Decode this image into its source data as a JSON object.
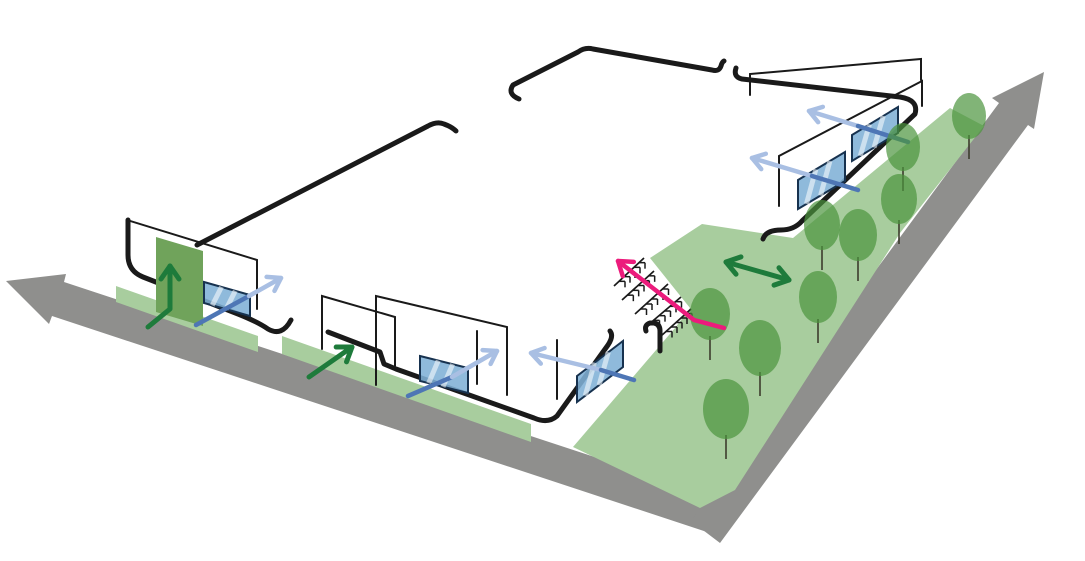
{
  "diagram": {
    "kind": "architectural-site-axonometric-diagram",
    "canvas": {
      "width": 1085,
      "height": 561,
      "background": "#ffffff"
    },
    "colors": {
      "road": "#8F8F8D",
      "lawn": "#A8CD9E",
      "tree": "#4B943D",
      "tree_stem": "#3C3C2C",
      "panel_green": "#70A35B",
      "glass_fill": "#7FB0D6",
      "glass_border": "#17324F",
      "glass_streak": "#FFFFFF",
      "outline": "#1A1A1A",
      "green_dark": "#1E7B3B",
      "blue_light": "#A9BFE3",
      "blue_dark": "#4E76B5",
      "pink": "#EC1B7C"
    },
    "roads": [
      {
        "name": "road-arrow-left",
        "points": [
          [
            6,
            281
          ],
          [
            66,
            274
          ],
          [
            64,
            282
          ],
          [
            728,
            501
          ],
          [
            716,
            535
          ],
          [
            52,
            316
          ],
          [
            49,
            324
          ]
        ]
      },
      {
        "name": "road-arrow-right",
        "points": [
          [
            1044,
            72
          ],
          [
            1034,
            129
          ],
          [
            1028,
            125
          ],
          [
            720,
            543
          ],
          [
            691,
            521
          ],
          [
            999,
            103
          ],
          [
            992,
            98
          ]
        ]
      }
    ],
    "lawns": [
      {
        "name": "lawn-strip-left",
        "points": [
          [
            116,
            286
          ],
          [
            258,
            336
          ],
          [
            258,
            352
          ],
          [
            116,
            302
          ]
        ]
      },
      {
        "name": "lawn-strip-center",
        "points": [
          [
            282,
            336
          ],
          [
            531,
            424
          ],
          [
            531,
            442
          ],
          [
            282,
            354
          ]
        ]
      },
      {
        "name": "lawn-main",
        "points": [
          [
            702,
            224
          ],
          [
            793,
            238
          ],
          [
            950,
            108
          ],
          [
            984,
            126
          ],
          [
            900,
            233
          ],
          [
            735,
            490
          ],
          [
            700,
            508
          ],
          [
            573,
            447
          ],
          [
            675,
            328
          ],
          [
            690,
            308
          ],
          [
            650,
            258
          ]
        ]
      }
    ],
    "outlines": [
      {
        "name": "building-outline-left",
        "d": "M 128,220 L 128,255 Q 128,271 143,277 L 238,314 Q 258,322 268,329 Q 282,337 291,320"
      },
      {
        "name": "site-outline-topleft",
        "d": "M 197,245 L 428,126 Q 437,121 444,124 Q 452,127 456,131"
      },
      {
        "name": "site-outline-top",
        "d": "M 519,99 Q 507,94 513,85 L 578,52 Q 585,47 593,49 L 712,70 Q 719,72 721,66 Q 722,62 724,61"
      },
      {
        "name": "building-outline-right",
        "d": "M 736,68 Q 733,77 742,79 L 900,97 Q 919,100 915,114 L 802,221 Q 794,230 781,230 Q 766,230 763,239"
      },
      {
        "name": "building-outline-center",
        "d": "M 328,332 L 380,352 L 384,364 L 396,369 L 534,418 Q 548,424 557,416 L 608,345 Q 614,336 610,331"
      },
      {
        "name": "building-outline-stair-edge",
        "d": "M 646,331 Q 644,325 650,323 L 654,323 Q 660,324 660,331 L 660,351"
      }
    ],
    "walls": [
      {
        "name": "wall-outline-left",
        "d": "M 127,244 L 127,220 L 257,260 L 257,309"
      },
      {
        "name": "wall-outline-center-a",
        "d": "M 322,349 L 322,296 L 395,317 L 395,366"
      },
      {
        "name": "wall-outline-center-b",
        "d": "M 376,385 L 376,296 L 507,327 L 507,395"
      },
      {
        "name": "wall-post-center",
        "d": "M 477,331 L 477,384"
      },
      {
        "name": "wall-post-corner",
        "d": "M 557,340 L 557,399"
      },
      {
        "name": "wall-outline-right",
        "d": "M 779,206 L 779,156 L 922,81 L 922,106"
      },
      {
        "name": "wall-outline-right-upper",
        "d": "M 750,95 L 750,74 L 921,59 L 921,80"
      }
    ],
    "green_panel": {
      "name": "green-wall-panel",
      "points": [
        [
          156,
          237
        ],
        [
          203,
          251
        ],
        [
          203,
          326
        ],
        [
          156,
          312
        ]
      ]
    },
    "glass_panels": [
      {
        "name": "glass-panel-left",
        "points": [
          [
            204,
            282
          ],
          [
            250,
            295
          ],
          [
            250,
            316
          ],
          [
            204,
            303
          ]
        ]
      },
      {
        "name": "glass-panel-center-1",
        "points": [
          [
            420,
            356
          ],
          [
            468,
            368
          ],
          [
            468,
            393
          ],
          [
            420,
            381
          ]
        ]
      },
      {
        "name": "glass-panel-center-2",
        "points": [
          [
            577,
            376
          ],
          [
            623,
            341
          ],
          [
            623,
            367
          ],
          [
            577,
            402
          ]
        ]
      },
      {
        "name": "glass-panel-right-1",
        "points": [
          [
            798,
            180
          ],
          [
            845,
            152
          ],
          [
            845,
            181
          ],
          [
            798,
            209
          ]
        ]
      },
      {
        "name": "glass-panel-right-2",
        "points": [
          [
            852,
            135
          ],
          [
            898,
            107
          ],
          [
            898,
            133
          ],
          [
            852,
            161
          ]
        ]
      }
    ],
    "stairs": {
      "name": "stairs-hatch",
      "rails": [
        [
          [
            614,
            286
          ],
          [
            644,
            258
          ]
        ],
        [
          [
            622,
            300
          ],
          [
            654,
            271
          ]
        ],
        [
          [
            635,
            314
          ],
          [
            668,
            284
          ]
        ],
        [
          [
            648,
            325
          ],
          [
            681,
            297
          ]
        ],
        [
          [
            661,
            336
          ],
          [
            691,
            309
          ]
        ]
      ],
      "steps_per_rail": 5,
      "step_size": 6
    },
    "arrows": [
      {
        "name": "airflow-arrow-left-dark",
        "pts": [
          [
            196,
            325
          ],
          [
            249,
            296
          ]
        ],
        "color": "blue_dark",
        "w": 4.5,
        "head": "none",
        "layer": 1
      },
      {
        "name": "airflow-arrow-left",
        "pts": [
          [
            249,
            296
          ],
          [
            281,
            278
          ]
        ],
        "color": "blue_light",
        "w": 4.5,
        "head": "end",
        "layer": 1
      },
      {
        "name": "airflow-arrow-center1-dark",
        "pts": [
          [
            408,
            396
          ],
          [
            452,
            377
          ]
        ],
        "color": "blue_dark",
        "w": 4.5,
        "head": "none",
        "layer": 1
      },
      {
        "name": "airflow-arrow-center1",
        "pts": [
          [
            452,
            377
          ],
          [
            497,
            351
          ]
        ],
        "color": "blue_light",
        "w": 4.5,
        "head": "end",
        "layer": 1
      },
      {
        "name": "airflow-arrow-center2",
        "pts": [
          [
            531,
            353
          ],
          [
            601,
            370
          ]
        ],
        "color": "blue_light",
        "w": 4.5,
        "head": "start",
        "layer": 1
      },
      {
        "name": "airflow-arrow-center2-dark",
        "pts": [
          [
            601,
            370
          ],
          [
            634,
            380
          ]
        ],
        "color": "blue_dark",
        "w": 4.5,
        "head": "none",
        "layer": 1
      },
      {
        "name": "airflow-arrow-right1",
        "pts": [
          [
            752,
            158
          ],
          [
            812,
            176
          ]
        ],
        "color": "blue_light",
        "w": 4.5,
        "head": "start",
        "layer": 1
      },
      {
        "name": "airflow-arrow-right1-dark",
        "pts": [
          [
            812,
            176
          ],
          [
            858,
            190
          ]
        ],
        "color": "blue_dark",
        "w": 4.5,
        "head": "none",
        "layer": 1
      },
      {
        "name": "airflow-arrow-right2",
        "pts": [
          [
            809,
            111
          ],
          [
            858,
            126
          ]
        ],
        "color": "blue_light",
        "w": 4.5,
        "head": "start",
        "layer": 1
      },
      {
        "name": "airflow-arrow-right2-dark",
        "pts": [
          [
            858,
            126
          ],
          [
            908,
            142
          ]
        ],
        "color": "blue_dark",
        "w": 4.5,
        "head": "none",
        "layer": 1
      },
      {
        "name": "green-arrow-up-panel",
        "pts": [
          [
            148,
            327
          ],
          [
            170,
            309
          ],
          [
            170,
            266
          ]
        ],
        "color": "green_dark",
        "w": 5,
        "head": "end",
        "layer": 1,
        "hl": 13,
        "hw": 9
      },
      {
        "name": "green-arrow-lawn",
        "pts": [
          [
            309,
            377
          ],
          [
            352,
            347
          ]
        ],
        "color": "green_dark",
        "w": 5,
        "head": "end",
        "layer": 1,
        "hl": 13,
        "hw": 9
      },
      {
        "name": "green-arrow-double",
        "pts": [
          [
            726,
            262
          ],
          [
            789,
            280
          ]
        ],
        "color": "green_dark",
        "w": 5,
        "head": "both",
        "layer": 1,
        "hl": 13,
        "hw": 9
      },
      {
        "name": "pedestrian-route-arrow-pink",
        "pts": [
          [
            724,
            328
          ],
          [
            694,
            320
          ],
          [
            618,
            261
          ]
        ],
        "color": "pink",
        "w": 4.5,
        "head": "end",
        "layer": 2,
        "hl": 13,
        "hw": 9
      }
    ],
    "trees": [
      {
        "cx": 903,
        "cy": 147,
        "rx": 17,
        "ry": 24
      },
      {
        "cx": 969,
        "cy": 116,
        "rx": 17,
        "ry": 23
      },
      {
        "cx": 899,
        "cy": 199,
        "rx": 18,
        "ry": 25
      },
      {
        "cx": 858,
        "cy": 235,
        "rx": 19,
        "ry": 26
      },
      {
        "cx": 822,
        "cy": 225,
        "rx": 18,
        "ry": 25
      },
      {
        "cx": 818,
        "cy": 297,
        "rx": 19,
        "ry": 26
      },
      {
        "cx": 710,
        "cy": 314,
        "rx": 20,
        "ry": 26
      },
      {
        "cx": 760,
        "cy": 348,
        "rx": 21,
        "ry": 28
      },
      {
        "cx": 726,
        "cy": 409,
        "rx": 23,
        "ry": 30
      }
    ]
  }
}
